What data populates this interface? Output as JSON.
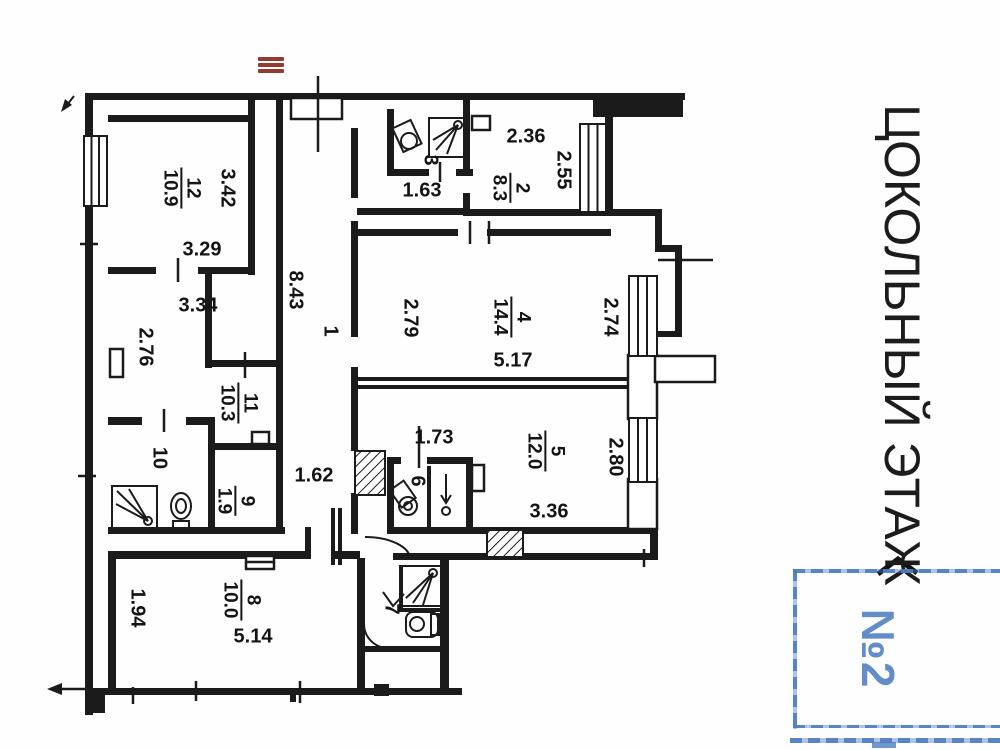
{
  "floor_title": "ЦОКОЛЬНЫЙ ЭТАЖ",
  "stamp": {
    "number": "№2"
  },
  "icons": {
    "menu": "hamburger-menu"
  },
  "rooms": [
    {
      "number": "12",
      "area": "10.9"
    },
    {
      "number": "2",
      "area": "8.3"
    },
    {
      "number": "4",
      "area": "14.4"
    },
    {
      "number": "5",
      "area": "12.0"
    },
    {
      "number": "11",
      "area": "10.3"
    },
    {
      "number": "9",
      "area": "1.9"
    },
    {
      "number": "8",
      "area": "10.0"
    }
  ],
  "plain_rooms": [
    {
      "number": "1"
    },
    {
      "number": "3"
    },
    {
      "number": "6"
    },
    {
      "number": "7"
    },
    {
      "number": "10"
    }
  ],
  "dimensions": {
    "d342": "3.42",
    "d329": "3.29",
    "d334": "3.34",
    "d276": "2.76",
    "d843": "8.43",
    "d163": "1.63",
    "d236": "2.36",
    "d255": "2.55",
    "d279": "2.79",
    "d274": "2.74",
    "d517": "5.17",
    "d173": "1.73",
    "d280": "2.80",
    "d336": "3.36",
    "d162": "1.62",
    "d514": "5.14",
    "d194": "1.94"
  },
  "colors": {
    "wall": "#1b1b1b",
    "accent_red": "#943a31",
    "stamp_blue": "#4d7ec1"
  }
}
